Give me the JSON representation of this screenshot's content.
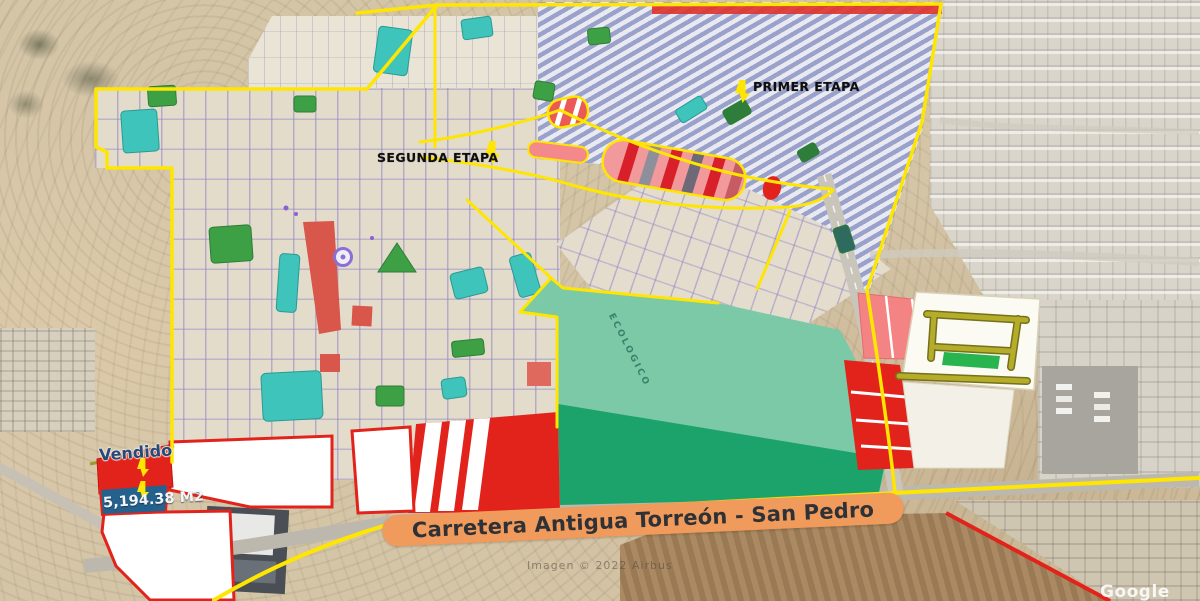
{
  "map": {
    "labels": {
      "primer_etapa": "PRIMER ETAPA",
      "segunda_etapa": "SEGUNDA ETAPA",
      "vendido": "Vendido",
      "lot_area": "5,194.38 M2",
      "road_banner": "Carretera Antigua Torreón - San Pedro",
      "green_zone": "ECOLOGICO",
      "imagery_credit": "Imagen © 2022 Airbus",
      "map_provider": "Google"
    },
    "colors": {
      "boundary_yellow": "#ffe600",
      "parcel_red": "#e2231c",
      "parcel_pink": "#f4989a",
      "sold_band_blue": "#24618c",
      "banner_orange": "#f09a5b",
      "reserve_green_light": "#7cc9a7",
      "reserve_green_dark": "#1ca36b",
      "pond_teal": "#3fc4bc",
      "park_green": "#3da045"
    }
  }
}
